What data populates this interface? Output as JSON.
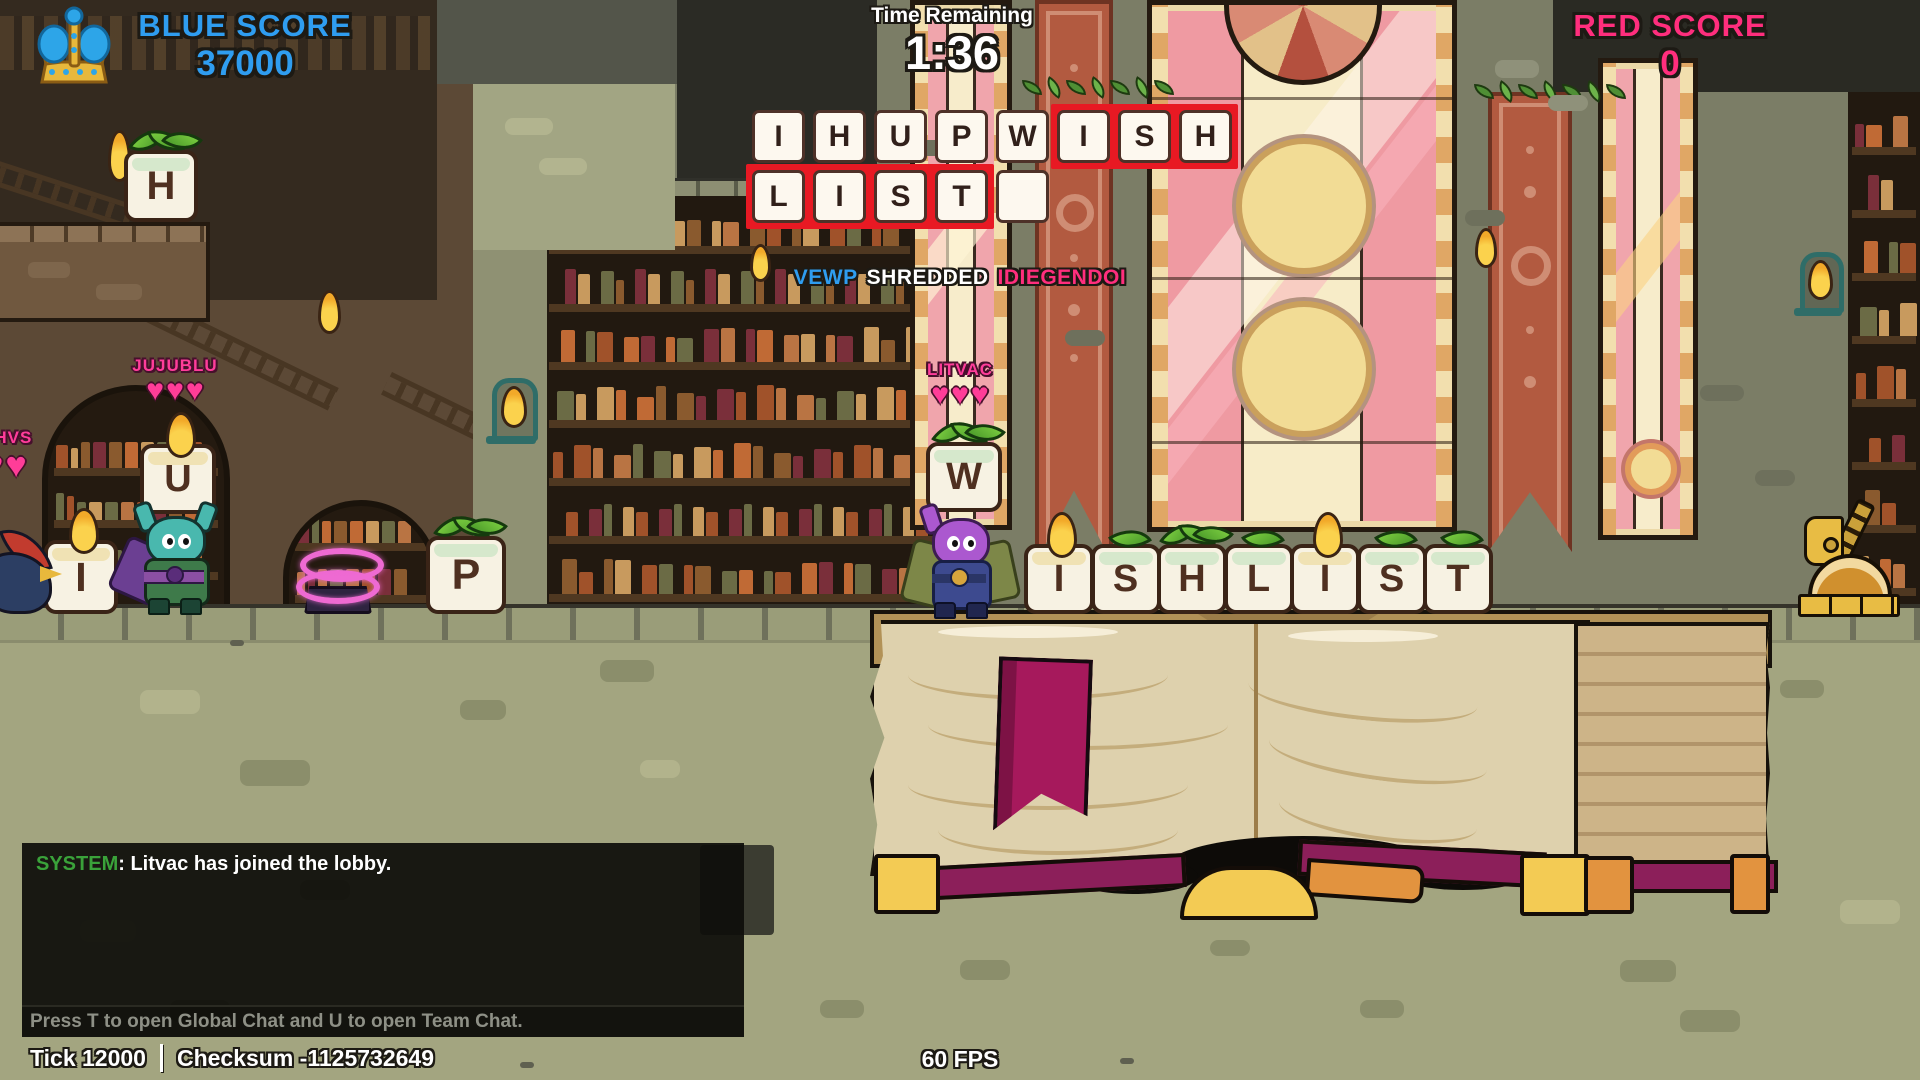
{
  "hud": {
    "blue_label": "BLUE SCORE",
    "blue_value": "37000",
    "time_label": "Time Remaining",
    "time_value": "1:36",
    "red_label": "RED SCORE",
    "red_value": "0",
    "colors": {
      "blue": "#2f9df0",
      "red_pink": "#ff2e7d",
      "highlight_red": "#e81923"
    }
  },
  "killfeed": {
    "attacker": "VEWP",
    "verb": "SHREDDED",
    "victim": "IDIEGENDOI",
    "attacker_color": "#2f9df0",
    "victim_color": "#ff2e7d"
  },
  "rack": {
    "rows": [
      {
        "tiles": [
          {
            "letter": "I",
            "highlight": false
          },
          {
            "letter": "H",
            "highlight": false
          },
          {
            "letter": "U",
            "highlight": false
          },
          {
            "letter": "P",
            "highlight": false
          },
          {
            "letter": "W",
            "highlight": false
          },
          {
            "letter": "I",
            "highlight": true
          },
          {
            "letter": "S",
            "highlight": true
          },
          {
            "letter": "H",
            "highlight": true
          }
        ]
      },
      {
        "tiles": [
          {
            "letter": "L",
            "highlight": true
          },
          {
            "letter": "I",
            "highlight": true
          },
          {
            "letter": "S",
            "highlight": true
          },
          {
            "letter": "T",
            "highlight": true
          },
          {
            "letter": "",
            "highlight": false
          }
        ]
      }
    ]
  },
  "players": [
    {
      "name": "SHVS",
      "hearts": 2
    },
    {
      "name": "JUJUBLU",
      "hearts": 3,
      "tile": {
        "letter": "U",
        "topper": "flame"
      }
    },
    {
      "name": "LITVAC",
      "hearts": 3,
      "tile": {
        "letter": "W",
        "topper": "sprout"
      }
    }
  ],
  "world": {
    "ledge_tiles": [
      {
        "letter": "H",
        "topper": "sprout"
      }
    ],
    "left_tiles": [
      {
        "letter": "I",
        "topper": "flame"
      },
      {
        "letter": "P",
        "topper": "sprout"
      }
    ],
    "word_tiles": [
      {
        "letter": "I",
        "topper": "flame"
      },
      {
        "letter": "S",
        "topper": "leaf"
      },
      {
        "letter": "H",
        "topper": "sprout"
      },
      {
        "letter": "L",
        "topper": "leaf"
      },
      {
        "letter": "I",
        "topper": "flame"
      },
      {
        "letter": "S",
        "topper": "leaf"
      },
      {
        "letter": "T",
        "topper": "leaf"
      }
    ]
  },
  "chat": {
    "system_label": "SYSTEM",
    "message": ": Litvac has joined the lobby.",
    "hint": "Press T to open Global Chat and U to open Team Chat."
  },
  "status": {
    "tick": "Tick 12000",
    "checksum": "Checksum -1125732649",
    "fps": "60 FPS"
  }
}
